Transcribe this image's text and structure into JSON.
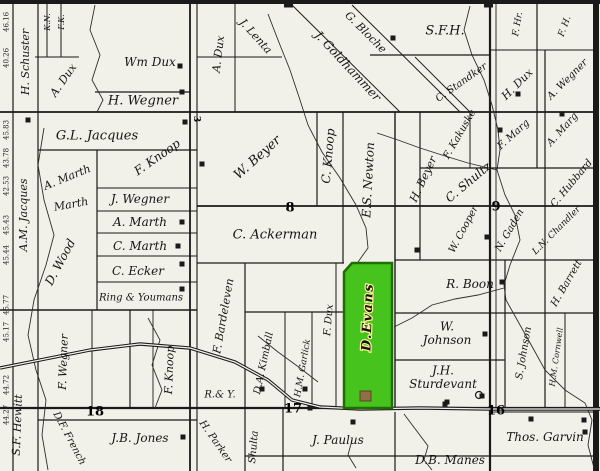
{
  "map": {
    "background": "#f1f0e9",
    "line_color": "#1a1a1a",
    "creek_color": "#2e2e2e",
    "highlight": {
      "label": "D.Evans",
      "fill": "#46c31d",
      "border": "#1e6f00",
      "label_color": "#141400",
      "label_halo": "#fff3a0",
      "polygon": [
        [
          352,
          263
        ],
        [
          392,
          263
        ],
        [
          392,
          408
        ],
        [
          344,
          408
        ],
        [
          344,
          272
        ]
      ],
      "building": {
        "x": 360,
        "y": 391,
        "w": 11,
        "h": 10,
        "fill": "#8f6f46",
        "border": "#5c4426"
      }
    },
    "section_numbers": [
      {
        "t": "8",
        "x": 290,
        "y": 207,
        "s": 13
      },
      {
        "t": "9",
        "x": 496,
        "y": 206,
        "s": 13
      },
      {
        "t": "18",
        "x": 95,
        "y": 411,
        "s": 13
      },
      {
        "t": "17",
        "x": 293,
        "y": 408,
        "s": 13
      },
      {
        "t": "16",
        "x": 496,
        "y": 410,
        "s": 13
      },
      {
        "t": "3",
        "x": 197,
        "y": 119,
        "s": 9,
        "r": 90
      }
    ],
    "margin_numbers": [
      {
        "t": "46.16",
        "y": 22
      },
      {
        "t": "40.26",
        "y": 58
      },
      {
        "t": "45.83",
        "y": 130
      },
      {
        "t": "43.78",
        "y": 158
      },
      {
        "t": "42.53",
        "y": 186
      },
      {
        "t": "45.43",
        "y": 225
      },
      {
        "t": "45.44",
        "y": 255
      },
      {
        "t": "45.77",
        "y": 305
      },
      {
        "t": "45.17",
        "y": 332
      },
      {
        "t": "44.72",
        "y": 385
      },
      {
        "t": "44.27",
        "y": 415
      }
    ],
    "labels": [
      {
        "t": "K.N.",
        "x": 47,
        "y": 22,
        "r": -90,
        "s": 8
      },
      {
        "t": "F.K.",
        "x": 61,
        "y": 22,
        "r": -90,
        "s": 8
      },
      {
        "t": "H. Schuster",
        "x": 25,
        "y": 62,
        "r": -90,
        "s": 11
      },
      {
        "t": "A.M. Jacques",
        "x": 23,
        "y": 215,
        "r": -90,
        "s": 11
      },
      {
        "t": "A. Dux",
        "x": 63,
        "y": 80,
        "r": -55,
        "s": 11
      },
      {
        "t": "Wm Dux",
        "x": 150,
        "y": 62,
        "r": 0,
        "s": 12
      },
      {
        "t": "H. Wegner",
        "x": 143,
        "y": 100,
        "r": 0,
        "s": 13
      },
      {
        "t": "G.L. Jacques",
        "x": 97,
        "y": 135,
        "r": 0,
        "s": 13
      },
      {
        "t": "A. Marth",
        "x": 67,
        "y": 177,
        "r": -22,
        "s": 11
      },
      {
        "t": "Marth",
        "x": 71,
        "y": 204,
        "r": -10,
        "s": 11
      },
      {
        "t": "F. Knoop",
        "x": 157,
        "y": 157,
        "r": -35,
        "s": 12
      },
      {
        "t": "J. Wegner",
        "x": 140,
        "y": 199,
        "r": 0,
        "s": 12
      },
      {
        "t": "A. Marth",
        "x": 140,
        "y": 222,
        "r": 0,
        "s": 12
      },
      {
        "t": "C. Marth",
        "x": 140,
        "y": 246,
        "r": 0,
        "s": 12
      },
      {
        "t": "C. Ecker",
        "x": 138,
        "y": 271,
        "r": 0,
        "s": 12
      },
      {
        "t": "Ring & Youmans",
        "x": 141,
        "y": 297,
        "r": 0,
        "s": 10
      },
      {
        "t": "D. Wood",
        "x": 60,
        "y": 262,
        "r": -62,
        "s": 12
      },
      {
        "t": "F. Wegner",
        "x": 63,
        "y": 362,
        "r": -88,
        "s": 11
      },
      {
        "t": "F. Knoop",
        "x": 169,
        "y": 370,
        "r": -88,
        "s": 11
      },
      {
        "t": "S.F. Hewitt",
        "x": 17,
        "y": 425,
        "r": -88,
        "s": 11
      },
      {
        "t": "D.F. French",
        "x": 70,
        "y": 438,
        "r": 62,
        "s": 10
      },
      {
        "t": "J.B. Jones",
        "x": 140,
        "y": 438,
        "r": 0,
        "s": 12
      },
      {
        "t": "H. Parker",
        "x": 216,
        "y": 441,
        "r": 55,
        "s": 10
      },
      {
        "t": "R.& Y.",
        "x": 220,
        "y": 394,
        "r": 0,
        "s": 10
      },
      {
        "t": "F. Bardeleven",
        "x": 223,
        "y": 316,
        "r": -80,
        "s": 11
      },
      {
        "t": "D.A. Kimball",
        "x": 263,
        "y": 363,
        "r": -78,
        "s": 10
      },
      {
        "t": "H.M. Garlick",
        "x": 302,
        "y": 368,
        "r": -80,
        "s": 9
      },
      {
        "t": "F. Dux",
        "x": 328,
        "y": 320,
        "r": -85,
        "s": 10
      },
      {
        "t": "Shulta",
        "x": 253,
        "y": 447,
        "r": -85,
        "s": 10
      },
      {
        "t": "J. Paulus",
        "x": 338,
        "y": 440,
        "r": 0,
        "s": 12
      },
      {
        "t": "A. Dux",
        "x": 218,
        "y": 54,
        "r": -83,
        "s": 11
      },
      {
        "t": "J. Lenta",
        "x": 256,
        "y": 36,
        "r": 48,
        "s": 11
      },
      {
        "t": "J. Goldhammer",
        "x": 348,
        "y": 66,
        "r": 47,
        "s": 12
      },
      {
        "t": "G. Bloche",
        "x": 366,
        "y": 32,
        "r": 45,
        "s": 11
      },
      {
        "t": "S.F.H.",
        "x": 445,
        "y": 30,
        "r": 0,
        "s": 13
      },
      {
        "t": "F. Hr.",
        "x": 517,
        "y": 24,
        "r": -80,
        "s": 9
      },
      {
        "t": "F. H.",
        "x": 564,
        "y": 26,
        "r": -70,
        "s": 9
      },
      {
        "t": "C. Standker",
        "x": 461,
        "y": 82,
        "r": -35,
        "s": 10
      },
      {
        "t": "H. Dux",
        "x": 517,
        "y": 84,
        "r": -45,
        "s": 11
      },
      {
        "t": "A. Wegner",
        "x": 567,
        "y": 79,
        "r": -45,
        "s": 10
      },
      {
        "t": "W. Beyer",
        "x": 257,
        "y": 157,
        "r": -42,
        "s": 13
      },
      {
        "t": "C. Knoop",
        "x": 328,
        "y": 156,
        "r": -85,
        "s": 12
      },
      {
        "t": "E.S. Newton",
        "x": 368,
        "y": 180,
        "r": -87,
        "s": 12
      },
      {
        "t": "H. Beyer",
        "x": 423,
        "y": 179,
        "r": -65,
        "s": 11
      },
      {
        "t": "F. Kakuske",
        "x": 459,
        "y": 134,
        "r": -60,
        "s": 10
      },
      {
        "t": "F. Marg",
        "x": 513,
        "y": 134,
        "r": -42,
        "s": 10
      },
      {
        "t": "A. Marg",
        "x": 562,
        "y": 129,
        "r": -48,
        "s": 10
      },
      {
        "t": "C. Shultz",
        "x": 468,
        "y": 182,
        "r": -40,
        "s": 12
      },
      {
        "t": "C. Hubbard",
        "x": 571,
        "y": 183,
        "r": -50,
        "s": 10
      },
      {
        "t": "W. Cooper",
        "x": 463,
        "y": 229,
        "r": -62,
        "s": 10
      },
      {
        "t": "N. Gaden",
        "x": 509,
        "y": 230,
        "r": -60,
        "s": 10
      },
      {
        "t": "L.N. Chandler",
        "x": 556,
        "y": 230,
        "r": -45,
        "s": 9
      },
      {
        "t": "C. Ackerman",
        "x": 275,
        "y": 234,
        "r": 0,
        "s": 13
      },
      {
        "t": "R. Boon",
        "x": 470,
        "y": 284,
        "r": 0,
        "s": 12
      },
      {
        "t": "W.|Johnson",
        "x": 447,
        "y": 333,
        "r": 0,
        "s": 12
      },
      {
        "t": "J.H.|Sturdevant",
        "x": 443,
        "y": 377,
        "r": 0,
        "s": 12
      },
      {
        "t": "S. Johnson",
        "x": 523,
        "y": 353,
        "r": -80,
        "s": 10
      },
      {
        "t": "H. Barrett",
        "x": 566,
        "y": 283,
        "r": -60,
        "s": 10
      },
      {
        "t": "H.M. Cornwell",
        "x": 556,
        "y": 357,
        "r": -82,
        "s": 8
      },
      {
        "t": "Thos. Garvin",
        "x": 545,
        "y": 437,
        "r": 0,
        "s": 12
      },
      {
        "t": "D.B. Manes",
        "x": 450,
        "y": 460,
        "r": 0,
        "s": 12
      }
    ],
    "buildings": [
      [
        180,
        66
      ],
      [
        182,
        92
      ],
      [
        185,
        122
      ],
      [
        28,
        120
      ],
      [
        202,
        164
      ],
      [
        182,
        222
      ],
      [
        178,
        246
      ],
      [
        182,
        264
      ],
      [
        182,
        289
      ],
      [
        393,
        38
      ],
      [
        518,
        94
      ],
      [
        500,
        130
      ],
      [
        562,
        114
      ],
      [
        487,
        237
      ],
      [
        502,
        282
      ],
      [
        485,
        334
      ],
      [
        445,
        404
      ],
      [
        353,
        422
      ],
      [
        531,
        419
      ],
      [
        584,
        420
      ],
      [
        585,
        432
      ],
      [
        183,
        437
      ],
      [
        262,
        389
      ],
      [
        305,
        389
      ],
      [
        447,
        402
      ],
      [
        482,
        396
      ],
      [
        310,
        408
      ],
      [
        417,
        250
      ]
    ],
    "corner_blobs": [
      [
        288,
        3
      ],
      [
        488,
        3
      ]
    ],
    "circle_marker": [
      479,
      395
    ],
    "grid_lines": [
      [
        0,
        2,
        600,
        2,
        4
      ],
      [
        13,
        0,
        13,
        471,
        1.2
      ],
      [
        38,
        0,
        38,
        471,
        1.2
      ],
      [
        47,
        0,
        47,
        57,
        1
      ],
      [
        61,
        0,
        61,
        57,
        1
      ],
      [
        35,
        57,
        79,
        57,
        1
      ],
      [
        190,
        0,
        190,
        471,
        1.8
      ],
      [
        197,
        0,
        197,
        471,
        1.1
      ],
      [
        235,
        4,
        235,
        112,
        1
      ],
      [
        197,
        57,
        282,
        57,
        1
      ],
      [
        317,
        112,
        317,
        206,
        1.2
      ],
      [
        343,
        112,
        343,
        263,
        1.2
      ],
      [
        395,
        112,
        395,
        408,
        1.4
      ],
      [
        420,
        112,
        420,
        260,
        1.2
      ],
      [
        470,
        112,
        470,
        168,
        1
      ],
      [
        537,
        4,
        537,
        168,
        1.2
      ],
      [
        490,
        2,
        490,
        471,
        2.2
      ],
      [
        496,
        4,
        496,
        408,
        0.9
      ],
      [
        505,
        260,
        505,
        408,
        1.2
      ],
      [
        545,
        50,
        545,
        408,
        1.2
      ],
      [
        565,
        313,
        565,
        408,
        1
      ],
      [
        245,
        263,
        245,
        471,
        1.2
      ],
      [
        285,
        312,
        285,
        408,
        1
      ],
      [
        312,
        312,
        312,
        408,
        1
      ],
      [
        336,
        263,
        336,
        408,
        1
      ],
      [
        283,
        408,
        283,
        471,
        1.2
      ],
      [
        395,
        412,
        395,
        471,
        1.2
      ],
      [
        130,
        310,
        130,
        408,
        1.2
      ],
      [
        153,
        310,
        153,
        408,
        0.9
      ],
      [
        92,
        310,
        92,
        408,
        1
      ],
      [
        95,
        92,
        190,
        92,
        1.2
      ],
      [
        0,
        112,
        597,
        112,
        1.8
      ],
      [
        38,
        150,
        197,
        150,
        1.2
      ],
      [
        97,
        150,
        97,
        310,
        1.2
      ],
      [
        97,
        188,
        197,
        188,
        1
      ],
      [
        97,
        211,
        197,
        211,
        1
      ],
      [
        97,
        233,
        197,
        233,
        1
      ],
      [
        97,
        256,
        197,
        256,
        1
      ],
      [
        97,
        282,
        197,
        282,
        1
      ],
      [
        0,
        310,
        197,
        310,
        1.4
      ],
      [
        197,
        206,
        597,
        206,
        1.8
      ],
      [
        420,
        168,
        597,
        168,
        1.2
      ],
      [
        395,
        260,
        597,
        260,
        1.2
      ],
      [
        395,
        313,
        597,
        313,
        1.2
      ],
      [
        395,
        360,
        505,
        360,
        1.2
      ],
      [
        370,
        55,
        490,
        55,
        1.2
      ],
      [
        490,
        50,
        597,
        50,
        1
      ],
      [
        197,
        263,
        344,
        263,
        1.2
      ],
      [
        245,
        312,
        344,
        312,
        1.2
      ],
      [
        0,
        408,
        600,
        408,
        2.2
      ],
      [
        38,
        420,
        197,
        420,
        1.2
      ],
      [
        245,
        456,
        597,
        456,
        1.3
      ],
      [
        493,
        412,
        597,
        412,
        0.9
      ],
      [
        292,
        5,
        400,
        112,
        1
      ],
      [
        352,
        5,
        460,
        112,
        1
      ],
      [
        415,
        57,
        470,
        112,
        0.9
      ],
      [
        596,
        0,
        596,
        471,
        6
      ]
    ],
    "creeks": [
      [
        [
          268,
          14
        ],
        [
          278,
          40
        ],
        [
          290,
          70
        ],
        [
          300,
          100
        ],
        [
          308,
          125
        ],
        [
          322,
          152
        ],
        [
          340,
          178
        ],
        [
          356,
          205
        ],
        [
          366,
          228
        ],
        [
          368,
          248
        ],
        [
          358,
          262
        ]
      ],
      [
        [
          470,
          6
        ],
        [
          464,
          30
        ],
        [
          472,
          55
        ],
        [
          484,
          80
        ],
        [
          492,
          105
        ],
        [
          498,
          130
        ],
        [
          500,
          150
        ],
        [
          497,
          170
        ],
        [
          505,
          195
        ],
        [
          515,
          215
        ],
        [
          520,
          240
        ],
        [
          510,
          265
        ],
        [
          504,
          285
        ],
        [
          506,
          300
        ],
        [
          520,
          325
        ],
        [
          534,
          350
        ],
        [
          545,
          370
        ],
        [
          565,
          390
        ],
        [
          585,
          403
        ],
        [
          592,
          420
        ],
        [
          588,
          445
        ],
        [
          594,
          468
        ]
      ],
      [
        [
          377,
          133
        ],
        [
          398,
          140
        ],
        [
          420,
          148
        ],
        [
          445,
          156
        ],
        [
          468,
          163
        ],
        [
          497,
          170
        ]
      ],
      [
        [
          44,
          128
        ],
        [
          38,
          165
        ],
        [
          44,
          200
        ],
        [
          54,
          235
        ],
        [
          46,
          265
        ],
        [
          34,
          300
        ],
        [
          28,
          335
        ],
        [
          36,
          370
        ],
        [
          46,
          400
        ],
        [
          42,
          435
        ],
        [
          48,
          470
        ]
      ],
      [
        [
          394,
          327
        ],
        [
          412,
          318
        ],
        [
          432,
          305
        ],
        [
          455,
          299
        ],
        [
          478,
          295
        ],
        [
          504,
          288
        ]
      ],
      [
        [
          352,
          440
        ],
        [
          348,
          455
        ],
        [
          356,
          468
        ]
      ],
      [
        [
          404,
          414
        ],
        [
          416,
          430
        ],
        [
          428,
          446
        ],
        [
          424,
          460
        ],
        [
          432,
          470
        ]
      ],
      [
        [
          95,
          5
        ],
        [
          90,
          30
        ],
        [
          100,
          55
        ],
        [
          92,
          80
        ],
        [
          103,
          100
        ],
        [
          97,
          112
        ]
      ],
      [
        [
          258,
          336
        ],
        [
          278,
          352
        ],
        [
          300,
          368
        ],
        [
          318,
          382
        ]
      ],
      [
        [
          148,
          318
        ],
        [
          160,
          340
        ],
        [
          152,
          365
        ],
        [
          162,
          390
        ],
        [
          155,
          408
        ]
      ]
    ],
    "railroad": [
      [
        0,
        368
      ],
      [
        40,
        360
      ],
      [
        90,
        350
      ],
      [
        140,
        344
      ],
      [
        190,
        348
      ],
      [
        235,
        362
      ],
      [
        268,
        380
      ],
      [
        292,
        400
      ],
      [
        320,
        407
      ],
      [
        360,
        409
      ],
      [
        420,
        408
      ],
      [
        490,
        409
      ],
      [
        600,
        409
      ]
    ]
  }
}
